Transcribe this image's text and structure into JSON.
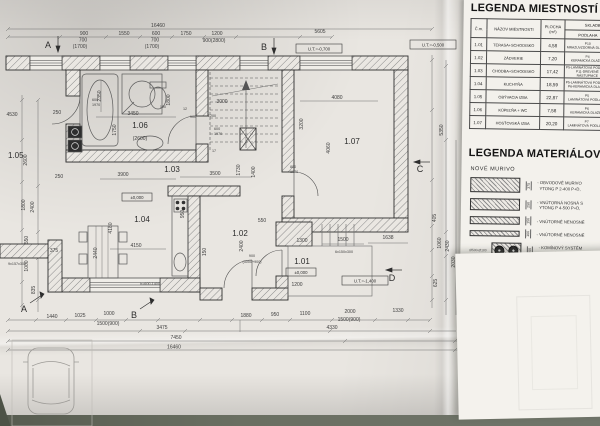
{
  "photo": {
    "colors": {
      "paper": "#e9e6e1",
      "legend_paper": "#f3f1ec",
      "table_surface": "#60655a",
      "ink": "#2f2f2f"
    }
  },
  "plan": {
    "rooms": [
      {
        "label": "1.05"
      },
      {
        "label": "1.06",
        "sub": "(2600)"
      },
      {
        "label": "1.03"
      },
      {
        "label": "1.04"
      },
      {
        "label": "1.02"
      },
      {
        "label": "1.01"
      },
      {
        "label": "1.07"
      }
    ],
    "grid_markers": {
      "top_a": "A",
      "top_b": "B",
      "right_c": "C",
      "right_d": "D",
      "bottom_a": "A",
      "bottom_b": "B"
    },
    "level_boxes": {
      "ut_700": "U.T.=-0,700",
      "ut_500": "U.T.=-0,500",
      "ut_1400": "U.T.=-1,400",
      "zero_terrace": "±0,000",
      "zero_kitchen": "±0,000"
    },
    "door_labels": {
      "bath_left": [
        "600",
        "1970"
      ],
      "bath_right": [
        "600",
        "1970"
      ],
      "guest": [
        "800",
        "1970"
      ],
      "entry": [
        "900",
        "(3000+900)"
      ]
    },
    "stairs": {
      "steps_note": "6x150x300",
      "ramp_note": "9x157x300",
      "step_count": "17"
    },
    "window_note": "h=600-1400",
    "dims_top": [
      "16460",
      "900",
      "700",
      "(1700)",
      "1550",
      "600",
      "700",
      "(1700)",
      "1750",
      "1200",
      "900(2800)",
      "5605"
    ],
    "dims_bottom": [
      "1440",
      "1025",
      "1000",
      "1500(900)",
      "3475",
      "1880",
      "950",
      "1100",
      "2000",
      "1500(900)",
      "1330",
      "4330",
      "7450",
      "16460"
    ],
    "dims_left": [
      "4530",
      "250",
      "2600",
      "1800",
      "2400",
      "550",
      "1000",
      "835"
    ],
    "dims_right": [
      "5350",
      "405",
      "1060",
      "2430",
      "2030",
      "625"
    ],
    "dims_inner": [
      "2350",
      "3450",
      "1750",
      "1800",
      "3000",
      "3500",
      "1730",
      "1400",
      "4080",
      "3200",
      "4060",
      "3900",
      "250",
      "950",
      "4150",
      "4180",
      "2440",
      "375",
      "550",
      "2400",
      "1300",
      "1500",
      "1638",
      "1200",
      "150",
      "100",
      "12",
      "900",
      "1200"
    ]
  },
  "legend_rooms": {
    "title": "LEGENDA MIESTNOSTÍ",
    "headers": {
      "num": "Č.m.",
      "name": "NÁZOV MIESTNOSTI",
      "area1": "PLOCHA",
      "area2": "(m²)",
      "skladba": "SKLADBA",
      "podlaha": "PODLAHA"
    },
    "rows": [
      {
        "num": "1.01",
        "name": "TERASA+SCHODISKO",
        "area": "4,58",
        "podlaha": [
          "P10",
          "MRAZUVZDORNÁ DLAŽBA"
        ]
      },
      {
        "num": "1.02",
        "name": "ZÁDVERIE",
        "area": "7,20",
        "podlaha": [
          "P4",
          "KERAMICKÁ DLAŽBA"
        ]
      },
      {
        "num": "1.03",
        "name": "CHODBA+SCHODISKO",
        "area": "17,42",
        "podlaha": [
          "P5-LAMINÁTOVÁ PODLAHA",
          "P11-DREVENÉ NÁSTUPNICE"
        ]
      },
      {
        "num": "1.04",
        "name": "KUCHYŇA",
        "area": "18,59",
        "podlaha": [
          "P5-LAMINÁTOVÁ PODLAHA",
          "P6-KERAMICKÁ DLAŽBA"
        ]
      },
      {
        "num": "1.05",
        "name": "OBÝVACIA IZBA",
        "area": "22,87",
        "podlaha": [
          "P5",
          "LAMINÁTOVÁ PODLAHA"
        ]
      },
      {
        "num": "1.06",
        "name": "KÚPEĽŇA + WC",
        "area": "7,58",
        "podlaha": [
          "P6",
          "KERAMICKÁ DLAŽBA"
        ]
      },
      {
        "num": "1.07",
        "name": "HOSŤOVSKÁ IZBA",
        "area": "20,20",
        "podlaha": [
          "P7",
          "LAMINÁTOVÁ PODLAHA"
        ]
      }
    ]
  },
  "legend_materials": {
    "title": "LEGENDA MATERIÁLOV",
    "subtitle": "NOVÉ MURIVO",
    "items": [
      {
        "thickness": "375",
        "line1": "- OBVODOVÉ MURIVO",
        "line2": "  YTONG P 2-400 P+D,"
      },
      {
        "thickness": "250",
        "line1": "- VNÚTORNÁ NOSNÁ S",
        "line2": "  YTONG P 4-500 P+D,"
      },
      {
        "thickness": "150",
        "line1": "- VNÚTORNÉ NENOSNÉ",
        "line2": ""
      },
      {
        "thickness": "100",
        "line1": "- VNÚTORNÉ NENOSNÉ",
        "line2": ""
      },
      {
        "thickness": "360",
        "line1": "- KOMÍNOVÝ SYSTÉM",
        "line2": "  SVETLÝ PRIEREZ Ø 1",
        "note": "Ø500-Ø180"
      }
    ]
  }
}
